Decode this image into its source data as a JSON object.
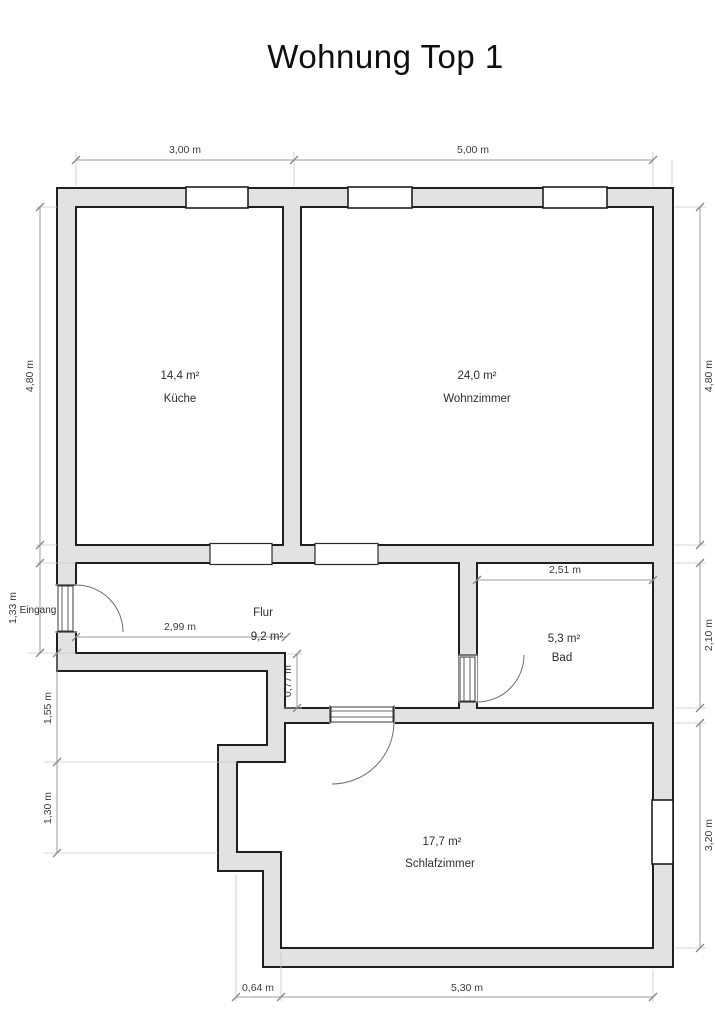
{
  "title": "Wohnung Top 1",
  "rooms": {
    "kueche": {
      "area": "14,4 m²",
      "name": "Küche"
    },
    "wohnzimmer": {
      "area": "24,0 m²",
      "name": "Wohnzimmer"
    },
    "flur": {
      "name": "Flur",
      "area": "9,2 m²"
    },
    "bad": {
      "area": "5,3 m²",
      "name": "Bad"
    },
    "schlafzimmer": {
      "area": "17,7 m²",
      "name": "Schlafzimmer"
    }
  },
  "labels": {
    "entrance": "Eingang"
  },
  "dimensions": {
    "top_kueche": "3,00 m",
    "top_wohnzimmer": "5,00 m",
    "left_kueche_height": "4,80 m",
    "left_entrance": "1,33 m",
    "left_step_upper": "1,55 m",
    "left_step_lower": "1,30 m",
    "right_wohnzimmer_height": "4,80 m",
    "right_bad_height": "2,10 m",
    "right_schlafzimmer_height": "3,20 m",
    "bottom_offset": "0,64 m",
    "bottom_schlafzimmer_width": "5,30 m",
    "flur_width": "2,99 m",
    "bad_width": "2,51 m",
    "flur_lower_depth": "0,77 m"
  },
  "colors": {
    "wall_fill": "#e2e2e2",
    "wall_stroke": "#1f1f1f",
    "dimension_line": "#9b9b9b",
    "text": "#3c3c3c"
  }
}
